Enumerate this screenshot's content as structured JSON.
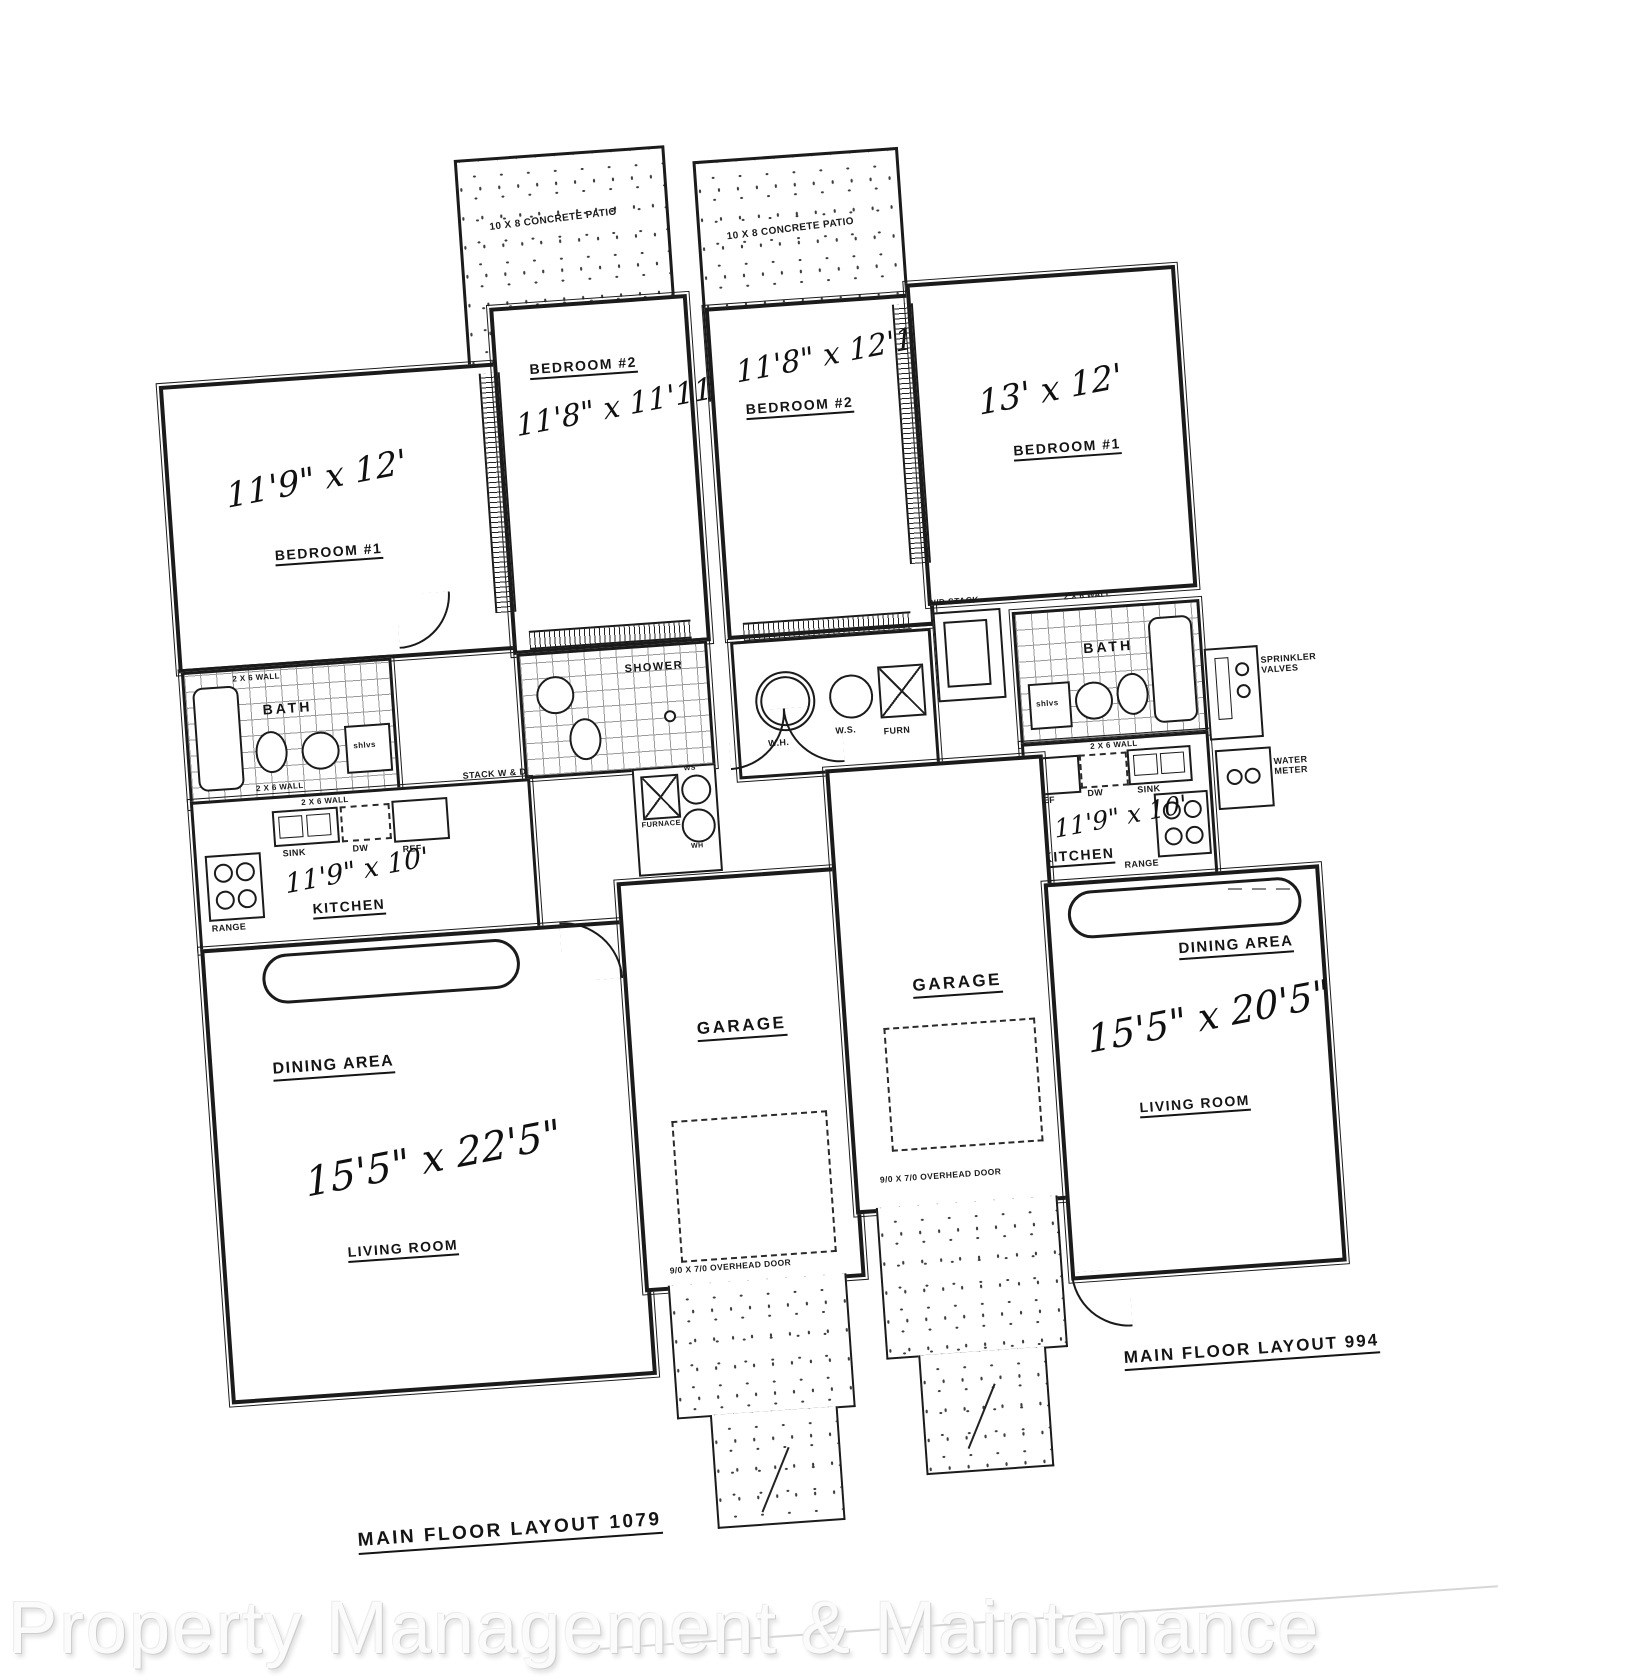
{
  "watermark": "Property Management & Maintenance",
  "plan": {
    "patio_label": "10 X 8 CONCRETE PATIO",
    "wall_note": "2 X 6 WALL",
    "shelves_note": "shlvs",
    "overhead_door_note": "9/0 X 7/0 OVERHEAD DOOR",
    "left_unit": {
      "layout_label": "MAIN FLOOR LAYOUT 1079",
      "bedroom1_name": "BEDROOM #1",
      "bedroom1_dim": "11'9\" x 12'",
      "bedroom2_name": "BEDROOM #2",
      "bedroom2_dim": "11'8\" x 11'11\"",
      "bath_name": "BATH",
      "shower_name": "SHOWER",
      "kitchen_name": "KITCHEN",
      "kitchen_dim": "11'9\" x 10'",
      "sink": "SINK",
      "dw": "DW",
      "ref": "REF",
      "range": "RANGE",
      "stack_wd": "STACK W & D",
      "furnace": "FURNACE",
      "ws": "WS",
      "wh": "WH",
      "dining_name": "DINING AREA",
      "living_name": "LIVING ROOM",
      "living_dim": "15'5\" x 22'5\"",
      "garage_name": "GARAGE"
    },
    "right_unit": {
      "layout_label": "MAIN FLOOR LAYOUT 994",
      "bedroom1_name": "BEDROOM #1",
      "bedroom1_dim": "13' x 12'",
      "bedroom2_name": "BEDROOM #2",
      "bedroom2_dim": "11'8\" x 12'1\"",
      "bath_name": "BATH",
      "wh": "W.H.",
      "ws": "W.S.",
      "furn": "FURN",
      "wd_stack": "W/D STACK",
      "kitchen_name": "KITCHEN",
      "kitchen_dim": "11'9\" x 10'",
      "sink": "SINK",
      "dw": "DW",
      "ref": "REF",
      "range": "RANGE",
      "dining_name": "DINING AREA",
      "living_name": "LIVING ROOM",
      "living_dim": "15'5\" x 20'5\"",
      "garage_name": "GARAGE",
      "sprinkler_valves": "SPRINKLER VALVES",
      "water_meter": "WATER METER"
    }
  }
}
